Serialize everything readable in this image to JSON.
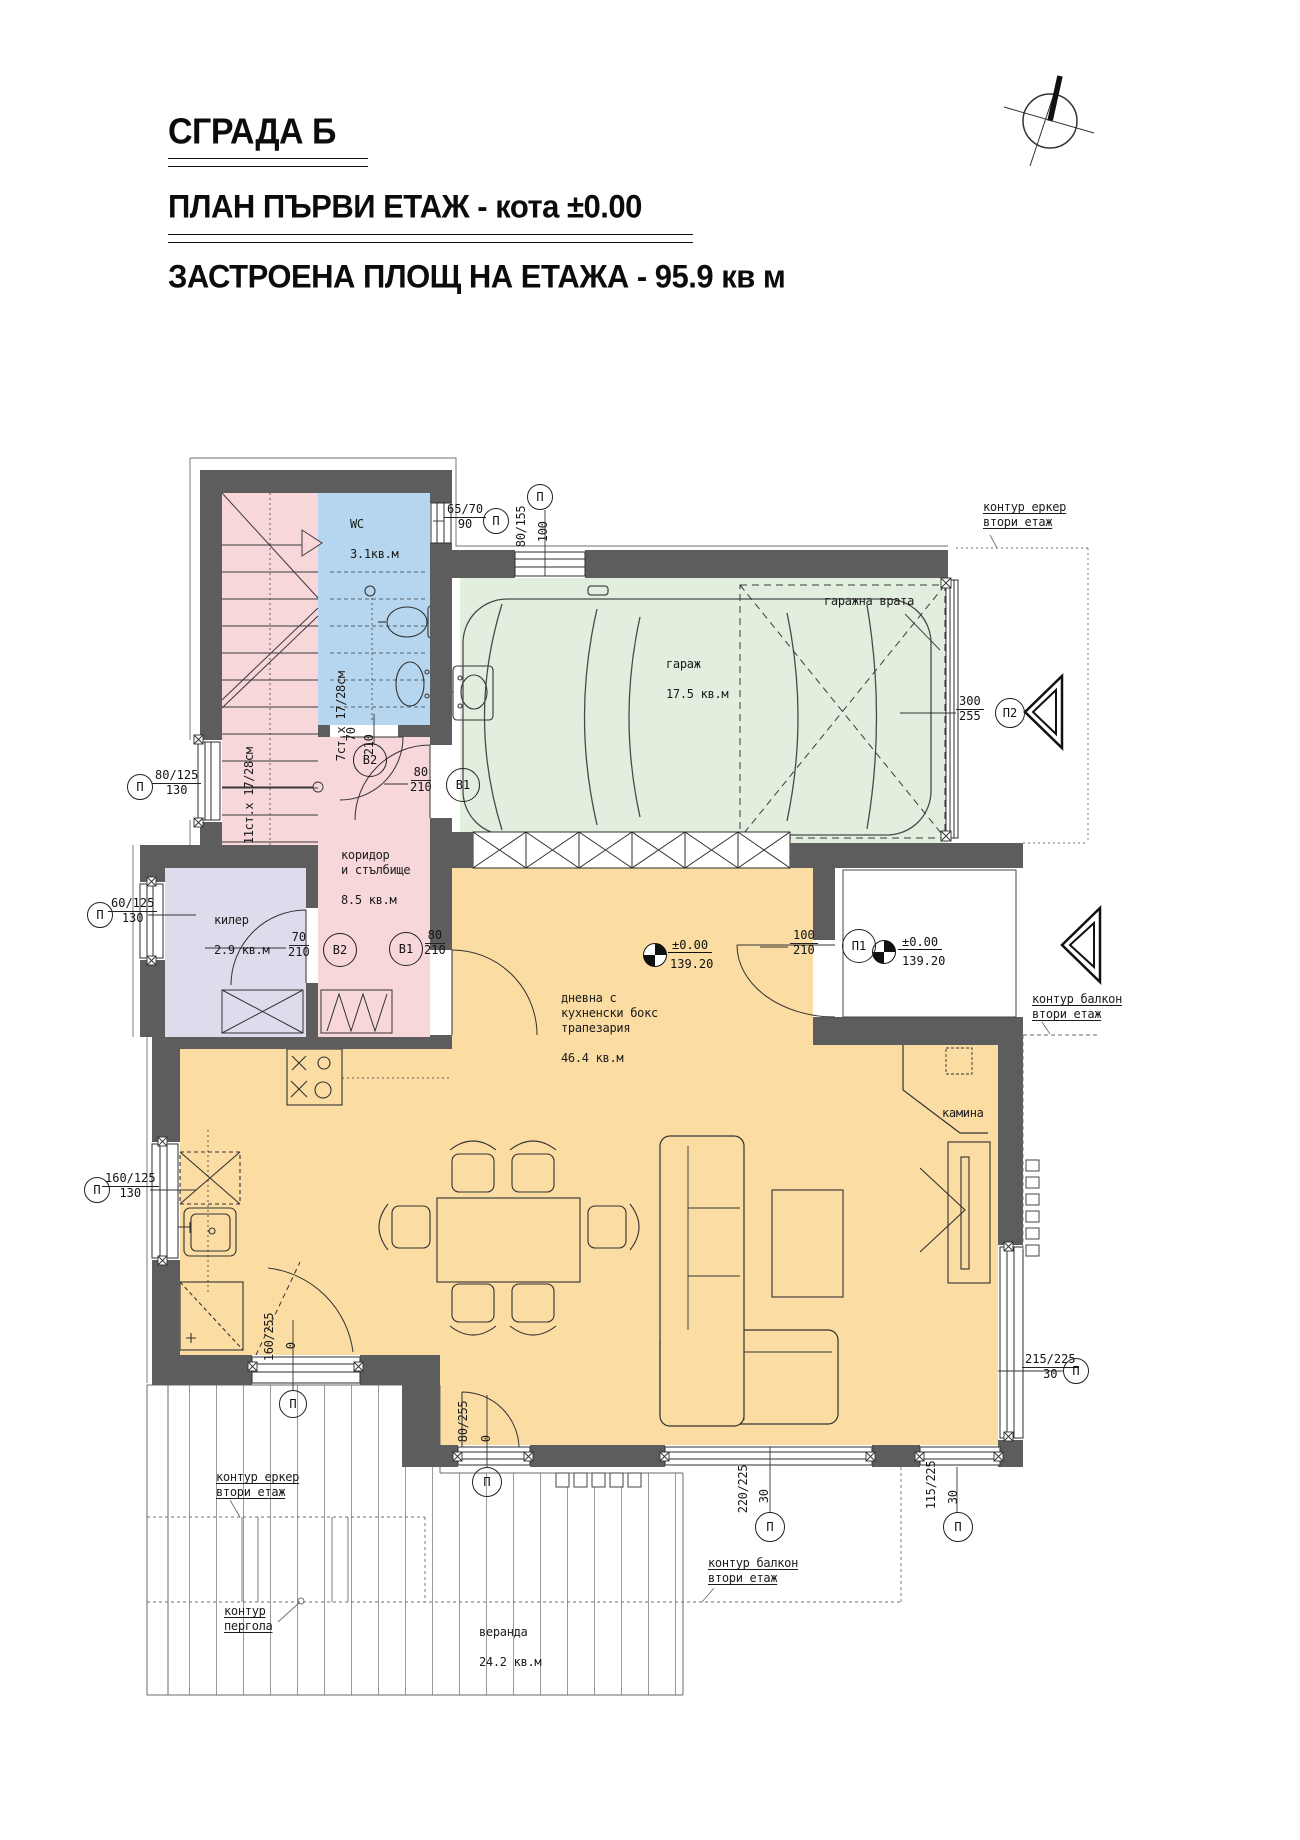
{
  "titles": {
    "building": "СГРАДА Б",
    "plan": "ПЛАН ПЪРВИ ЕТАЖ - кота ±0.00",
    "area": "ЗАСТРОЕНА ПЛОЩ НА ЕТАЖА - 95.9 кв м"
  },
  "rooms": {
    "wc": {
      "name": "WC",
      "area": "3.1кв.м"
    },
    "corridor": {
      "name": "коридор\nи стълбище",
      "area": "8.5 кв.м"
    },
    "storage": {
      "name": "килер",
      "area": "2.9 кв.м"
    },
    "garage": {
      "name": "гараж",
      "area": "17.5 кв.м"
    },
    "living": {
      "name": "дневна с\nкухненски бокс\nтрапезария",
      "area": "46.4 кв.м"
    },
    "veranda": {
      "name": "веранда",
      "area": "24.2 кв.м"
    }
  },
  "stairs": {
    "flight_lower": "11ст.х 17/28см",
    "flight_upper": "7ст.х 17/28см"
  },
  "annotations": {
    "garage_door": "гаражна врата",
    "fireplace": "камина",
    "bay_contour_top": "контур еркер\nвтори етаж",
    "balcony_contour_right": "контур балкон\nвтори етаж",
    "balcony_contour_bottom": "контур балкон\nвтори етаж",
    "bay_contour_bottom": "контур еркер\nвтори етаж",
    "pergola_contour": "контур\nпергола"
  },
  "levels": {
    "living": {
      "elevation": "±0.00",
      "absolute": "139.20"
    },
    "entry": {
      "elevation": "±0.00",
      "absolute": "139.20"
    }
  },
  "openings": {
    "wc_window": {
      "num": "65/70",
      "den": "90",
      "tag": "П"
    },
    "garage_window": {
      "num": "80/155",
      "den": "100",
      "tag": "П"
    },
    "stair_window": {
      "num": "80/125",
      "den": "130",
      "tag": "П"
    },
    "storage_window": {
      "num": "60/125",
      "den": "130",
      "tag": "П"
    },
    "kitchen_window": {
      "num": "160/125",
      "den": "130",
      "tag": "П"
    },
    "kitchen_terrace_door": {
      "num": "160/255",
      "den": "0",
      "tag": "П"
    },
    "living_terrace_door": {
      "num": "80/255",
      "den": "0",
      "tag": "П"
    },
    "terrace_window_large": {
      "num": "220/225",
      "den": "30",
      "tag": "П"
    },
    "terrace_window_small": {
      "num": "115/225",
      "den": "30",
      "tag": "П"
    },
    "side_window": {
      "num": "215/225",
      "den": "30",
      "tag": "П"
    },
    "garage_gate": {
      "num": "300",
      "den": "255",
      "tag": "П2"
    },
    "entry_door": {
      "num": "100",
      "den": "210",
      "tag": "П1"
    },
    "wc_door": {
      "num": "70",
      "den": "210",
      "tag": "В2"
    },
    "storage_door": {
      "num": "70",
      "den": "210",
      "tag": "В2"
    },
    "garage_door_inner": {
      "num": "80",
      "den": "210",
      "tag": "В1"
    },
    "living_door_inner": {
      "num": "80",
      "den": "210",
      "tag": "В1"
    }
  },
  "colors": {
    "wall": "#5d5d5d",
    "stair_corridor": "#f8d7da",
    "wc": "#b5d6ee",
    "garage": "#e2efde",
    "storage": "#dcdcec",
    "living": "#fbdca2"
  }
}
